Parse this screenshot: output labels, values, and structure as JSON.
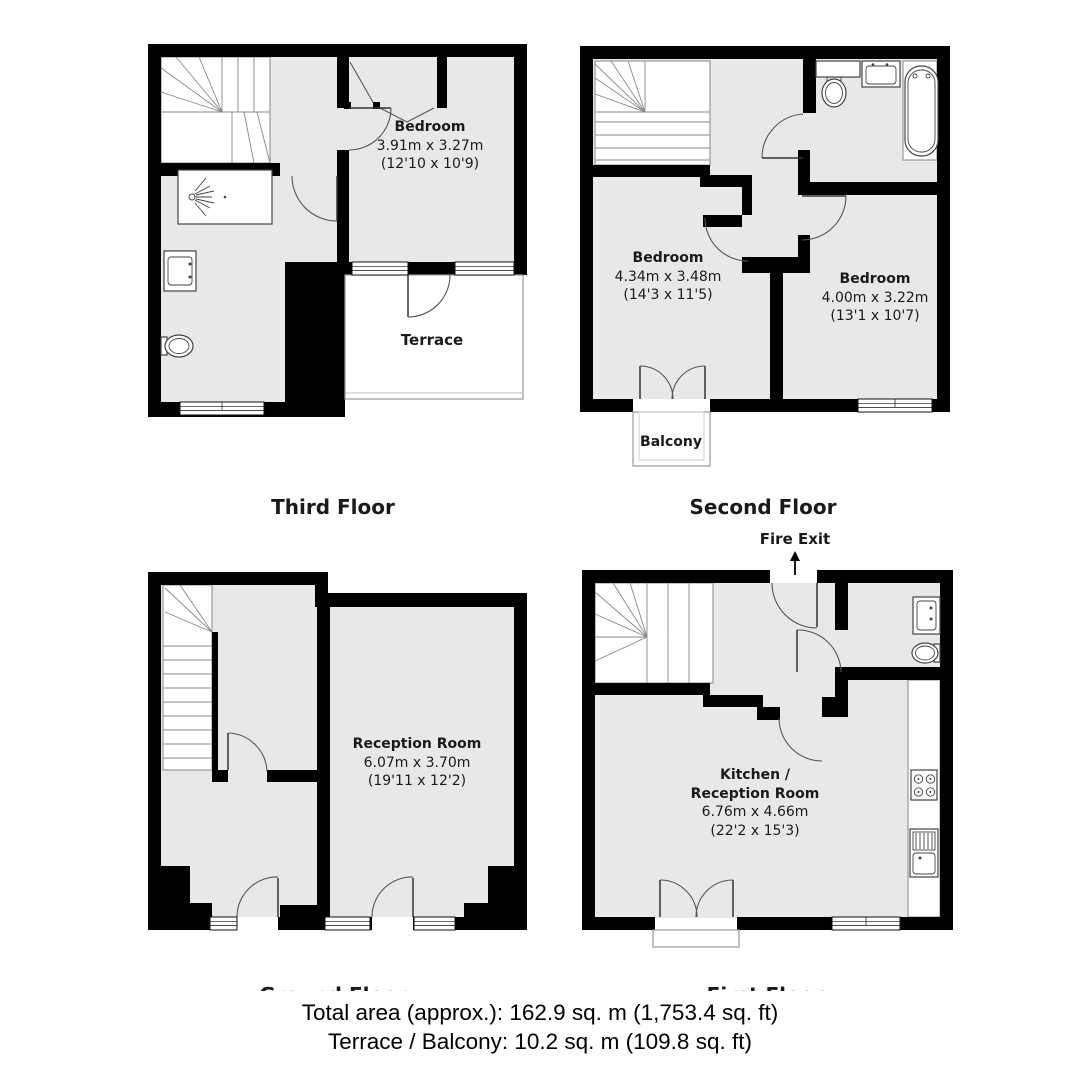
{
  "floors": {
    "third": {
      "title": "Third Floor",
      "bedroom": {
        "name": "Bedroom",
        "dim_m": "3.91m x 3.27m",
        "dim_ft": "(12'10 x 10'9)"
      },
      "terrace": "Terrace"
    },
    "second": {
      "title": "Second Floor",
      "bedroom1": {
        "name": "Bedroom",
        "dim_m": "4.34m x 3.48m",
        "dim_ft": "(14'3 x 11'5)"
      },
      "bedroom2": {
        "name": "Bedroom",
        "dim_m": "4.00m x 3.22m",
        "dim_ft": "(13'1 x 10'7)"
      },
      "balcony": "Balcony"
    },
    "ground": {
      "title": "Ground Floor",
      "reception": {
        "name": "Reception Room",
        "dim_m": "6.07m x 3.70m",
        "dim_ft": "(19'11 x 12'2)"
      }
    },
    "first": {
      "title": "First Floor",
      "fire_exit": "Fire Exit",
      "kitchen": {
        "name1": "Kitchen /",
        "name2": "Reception Room",
        "dim_m": "6.76m x 4.66m",
        "dim_ft": "(22'2 x 15'3)"
      }
    }
  },
  "summary": {
    "total_area": "Total area (approx.): 162.9 sq. m (1,753.4 sq. ft)",
    "terrace_balcony": "Terrace / Balcony: 10.2 sq. m (109.8 sq. ft)"
  },
  "colors": {
    "wall": "#000000",
    "floor_fill": "#e8e8e8",
    "detail_line": "#555555"
  }
}
